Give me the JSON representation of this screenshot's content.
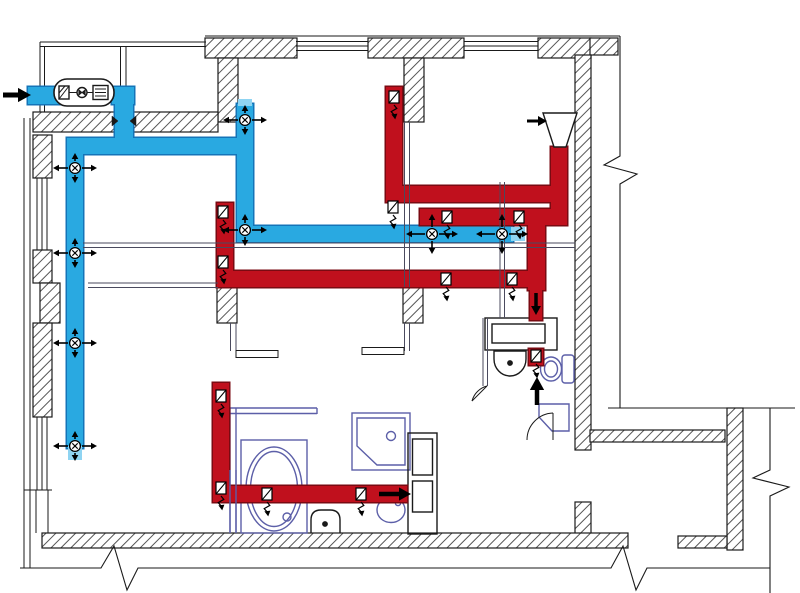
{
  "meta": {
    "title": "apartment-ventilation-duct-floor-plan",
    "canvas": {
      "width": 800,
      "height": 593,
      "background": "#ffffff"
    }
  },
  "colors": {
    "line": "#1a1a1a",
    "hatch": "#555555",
    "partition": "#4a4a5e",
    "fixture": "#5c5fa8",
    "supply_fill": "#29a9e1",
    "supply_stroke": "#1474b8",
    "supply_light": "#8fd4f2",
    "exhaust_fill": "#c0101d",
    "exhaust_stroke": "#7a0a12",
    "symbol": "#000000"
  },
  "walls": {
    "blocks": [
      [
        205,
        38,
        92,
        20
      ],
      [
        368,
        38,
        96,
        20
      ],
      [
        538,
        38,
        53,
        20
      ],
      [
        590,
        38,
        28,
        17
      ],
      [
        218,
        58,
        20,
        64
      ],
      [
        404,
        58,
        20,
        64
      ],
      [
        575,
        55,
        16,
        395
      ],
      [
        575,
        502,
        16,
        46
      ],
      [
        590,
        430,
        135,
        12
      ],
      [
        727,
        408,
        16,
        142
      ],
      [
        678,
        536,
        49,
        12
      ],
      [
        42,
        533,
        586,
        15
      ],
      [
        33,
        112,
        185,
        20
      ],
      [
        33,
        135,
        19,
        43
      ],
      [
        33,
        250,
        19,
        33
      ],
      [
        40,
        283,
        20,
        40
      ],
      [
        33,
        323,
        19,
        94
      ],
      [
        217,
        287,
        20,
        36
      ],
      [
        403,
        287,
        20,
        36
      ]
    ],
    "thin_lines": [
      [
        40,
        42,
        206,
        42
      ],
      [
        40,
        46.5,
        206,
        46.5
      ],
      [
        40,
        42,
        40,
        112
      ],
      [
        44.5,
        46.5,
        44.5,
        112
      ],
      [
        24,
        118,
        24,
        568
      ],
      [
        30,
        118,
        30,
        568
      ],
      [
        120.5,
        46.5,
        120.5,
        87
      ],
      [
        126,
        46.5,
        126,
        87
      ],
      [
        24,
        490,
        52,
        490
      ],
      [
        37,
        178,
        37,
        250
      ],
      [
        42,
        178,
        42,
        250
      ],
      [
        47,
        178,
        47,
        250
      ],
      [
        37,
        417,
        37,
        490
      ],
      [
        42,
        417,
        42,
        490
      ],
      [
        47,
        417,
        47,
        490
      ],
      [
        36,
        490,
        36,
        533
      ],
      [
        48,
        490,
        48,
        533
      ],
      [
        205,
        36,
        620,
        36
      ],
      [
        296,
        41.5,
        368,
        41.5
      ],
      [
        296,
        46,
        368,
        46
      ],
      [
        296,
        50.5,
        368,
        50.5
      ],
      [
        464,
        41.5,
        538,
        41.5
      ],
      [
        464,
        46,
        538,
        46
      ],
      [
        464,
        50.5,
        538,
        50.5
      ],
      [
        608,
        408,
        795,
        408
      ]
    ],
    "break_paths": [
      "M20,568 L101,568 L114,546 L127,590 L138,568 L611,568 L623,546 L636,590 L647,568 L770,568",
      "M770,408 L770,470 L753,478 L789,487 L770,496 L770,593",
      "M620,36 L620,156 L604,165 L637,174 L620,184 L620,408"
    ]
  },
  "partitions": {
    "lines": [
      [
        88,
        283,
        218,
        283
      ],
      [
        88,
        287.5,
        218,
        287.5
      ],
      [
        404.5,
        122,
        404.5,
        287
      ],
      [
        409.5,
        122,
        409.5,
        287
      ],
      [
        230.5,
        323,
        230.5,
        351
      ],
      [
        236,
        323,
        236,
        351
      ],
      [
        404.5,
        323,
        404.5,
        351
      ],
      [
        409.5,
        323,
        409.5,
        351
      ],
      [
        483,
        318,
        483,
        386
      ],
      [
        487.5,
        318,
        487.5,
        386
      ],
      [
        500,
        182,
        500,
        318
      ],
      [
        504.5,
        182,
        504.5,
        318
      ],
      [
        83,
        243,
        575,
        243
      ],
      [
        83,
        247.5,
        575,
        247.5
      ]
    ],
    "door_leaves": [
      [
        236,
        350.5,
        42,
        7
      ],
      [
        362,
        347.5,
        42,
        7
      ]
    ],
    "overlay_fixture_lines": [
      [
        230,
        470,
        230,
        533
      ],
      [
        236,
        470,
        236,
        533
      ]
    ]
  },
  "supply": {
    "segments": [
      [
        28,
        87,
        34,
        17
      ],
      [
        112,
        87,
        22,
        17
      ],
      [
        115,
        90,
        18,
        52
      ],
      [
        67,
        138,
        186,
        16
      ],
      [
        67,
        138,
        16,
        310
      ],
      [
        237,
        104,
        16,
        135
      ],
      [
        237,
        226,
        276,
        16
      ]
    ],
    "light_tips": [
      [
        68,
        446,
        14,
        14
      ],
      [
        238,
        99,
        14,
        7
      ],
      [
        511,
        227,
        14,
        14
      ]
    ],
    "diffusers": [
      {
        "x": 245,
        "y": 120,
        "a": 22,
        "b": 15
      },
      {
        "x": 75,
        "y": 168,
        "a": 22,
        "b": 15
      },
      {
        "x": 75,
        "y": 253,
        "a": 22,
        "b": 15
      },
      {
        "x": 75,
        "y": 343,
        "a": 22,
        "b": 15
      },
      {
        "x": 75,
        "y": 446,
        "a": 22,
        "b": 15
      },
      {
        "x": 245,
        "y": 230,
        "a": 22,
        "b": 16
      },
      {
        "x": 432,
        "y": 234,
        "a": 26,
        "b": 20
      },
      {
        "x": 502,
        "y": 234,
        "a": 26,
        "b": 20
      }
    ]
  },
  "exhaust": {
    "segments": [
      [
        386,
        87,
        16,
        110
      ],
      [
        386,
        186,
        181,
        16
      ],
      [
        551,
        147,
        16,
        70
      ],
      [
        420,
        209,
        147,
        16
      ],
      [
        528,
        218,
        17,
        72
      ],
      [
        530,
        290,
        12,
        30
      ],
      [
        217,
        203,
        16,
        84
      ],
      [
        217,
        271,
        328,
        16
      ],
      [
        213,
        383,
        16,
        117
      ],
      [
        213,
        486,
        194,
        16
      ],
      [
        529,
        349,
        14,
        16
      ]
    ],
    "grilles": [
      [
        394,
        97
      ],
      [
        393,
        207
      ],
      [
        223,
        212
      ],
      [
        223,
        262
      ],
      [
        447,
        217
      ],
      [
        519,
        217
      ],
      [
        446,
        279
      ],
      [
        512,
        279
      ],
      [
        221,
        396
      ],
      [
        221,
        488
      ],
      [
        267,
        494
      ],
      [
        361,
        494
      ],
      [
        536,
        356
      ]
    ]
  },
  "arrows": [
    {
      "x1": 3,
      "y1": 95,
      "x2": 31,
      "y2": 95,
      "w": 5,
      "h": 13,
      "n": "outside-air-intake-arrow"
    },
    {
      "x1": 527,
      "y1": 121,
      "x2": 547,
      "y2": 121,
      "w": 3,
      "h": 9,
      "n": "hood-flow-arrow"
    },
    {
      "x1": 536,
      "y1": 293,
      "x2": 536,
      "y2": 315,
      "w": 3.5,
      "h": 9,
      "n": "shaft-down-arrow"
    },
    {
      "x1": 537,
      "y1": 405,
      "x2": 537,
      "y2": 377,
      "w": 4.5,
      "h": 13,
      "n": "wc-up-arrow"
    },
    {
      "x1": 379,
      "y1": 494,
      "x2": 411,
      "y2": 494,
      "w": 4.5,
      "h": 12,
      "n": "bathroom-exhaust-arrow"
    }
  ],
  "symbols": [
    {
      "t": "rect",
      "x": 54,
      "y": 79,
      "w": 60,
      "h": 27,
      "rx": 13,
      "s": "bk",
      "f": "#fff",
      "sw": 1.6,
      "n": "ahu-casing"
    },
    {
      "t": "rect",
      "x": 59,
      "y": 86,
      "w": 10,
      "h": 13,
      "s": "bk",
      "f": "#fff",
      "n": "ahu-filter"
    },
    {
      "t": "line",
      "x1": 59,
      "y1": 99,
      "x2": 69,
      "y2": 86,
      "s": "bk",
      "sw": 1
    },
    {
      "t": "line",
      "x1": 59,
      "y1": 93,
      "x2": 65,
      "y2": 86,
      "s": "bk",
      "sw": 1
    },
    {
      "t": "line",
      "x1": 69,
      "y1": 92.5,
      "x2": 77,
      "y2": 92.5,
      "s": "bk",
      "sw": 1
    },
    {
      "t": "circle",
      "cx": 82,
      "cy": 92.5,
      "r": 5,
      "s": "bk",
      "f": "#fff",
      "n": "ahu-fan"
    },
    {
      "t": "path",
      "d": "M78.8,89.8 L78.8,95.2 L82,92.5 Z",
      "s": "bk",
      "f": "#1a1a1a",
      "sw": 0.8
    },
    {
      "t": "path",
      "d": "M85.2,89.8 L85.2,95.2 L82,92.5 Z",
      "s": "bk",
      "f": "#1a1a1a",
      "sw": 0.8
    },
    {
      "t": "line",
      "x1": 87,
      "y1": 92.5,
      "x2": 93,
      "y2": 92.5,
      "s": "bk",
      "sw": 1
    },
    {
      "t": "rect",
      "x": 93,
      "y": 85.5,
      "w": 15,
      "h": 14,
      "s": "bk",
      "f": "#fff",
      "n": "ahu-heater"
    },
    {
      "t": "line",
      "x1": 95,
      "y1": 89,
      "x2": 106,
      "y2": 89,
      "s": "bk",
      "sw": 1
    },
    {
      "t": "line",
      "x1": 95,
      "y1": 92.5,
      "x2": 106,
      "y2": 92.5,
      "s": "bk",
      "sw": 1
    },
    {
      "t": "line",
      "x1": 95,
      "y1": 96,
      "x2": 106,
      "y2": 96,
      "s": "bk",
      "sw": 1
    },
    {
      "t": "path",
      "d": "M543,113 L577,113 L566,147 L554,147 Z",
      "s": "bk",
      "f": "#fff",
      "sw": 1.4,
      "n": "kitchen-hood"
    },
    {
      "t": "path",
      "d": "M112,116 L118,121 L112,126 Z",
      "s": "bk",
      "f": "#1a1a1a",
      "sw": 0.5,
      "n": "wall-crossing-tick"
    },
    {
      "t": "path",
      "d": "M136,116 L130,121 L136,126 Z",
      "s": "bk",
      "f": "#1a1a1a",
      "sw": 0.5,
      "n": "wall-crossing-tick"
    }
  ],
  "fixtures": [
    {
      "t": "line",
      "x1": 230,
      "y1": 408,
      "x2": 230,
      "y2": 533,
      "s": "fx",
      "n": "bathroom-wall"
    },
    {
      "t": "line",
      "x1": 236,
      "y1": 408,
      "x2": 236,
      "y2": 533,
      "s": "fx"
    },
    {
      "t": "line",
      "x1": 230,
      "y1": 408,
      "x2": 317,
      "y2": 408,
      "s": "fx"
    },
    {
      "t": "line",
      "x1": 230,
      "y1": 413.5,
      "x2": 317,
      "y2": 413.5,
      "s": "fx"
    },
    {
      "t": "line",
      "x1": 317,
      "y1": 408,
      "x2": 317,
      "y2": 414,
      "s": "fx"
    },
    {
      "t": "rect",
      "x": 241,
      "y": 440,
      "w": 66,
      "h": 93,
      "s": "fx",
      "n": "bathtub-deck"
    },
    {
      "t": "ellipse",
      "cx": 274,
      "cy": 489,
      "rx": 28,
      "ry": 42,
      "s": "fx",
      "n": "bathtub"
    },
    {
      "t": "ellipse",
      "cx": 274,
      "cy": 489,
      "rx": 23.5,
      "ry": 37.5,
      "s": "fx"
    },
    {
      "t": "circle",
      "cx": 287,
      "cy": 517,
      "r": 4,
      "s": "fx",
      "n": "bathtub-drain"
    },
    {
      "t": "rect",
      "x": 352,
      "y": 413,
      "w": 58,
      "h": 57,
      "s": "fx",
      "n": "shower-cabin"
    },
    {
      "t": "path",
      "d": "M357,418 L405,418 L405,465 L377,465 L357,446 Z",
      "s": "fx"
    },
    {
      "t": "circle",
      "cx": 391,
      "cy": 436,
      "r": 4.5,
      "s": "fx",
      "n": "shower-drain"
    },
    {
      "t": "path",
      "d": "M311,533 L311,520 Q311,510 321,510 L330,510 Q340,510 340,520 L340,533",
      "s": "bk",
      "n": "bathroom-toilet"
    },
    {
      "t": "circle",
      "cx": 325,
      "cy": 524,
      "r": 2.2,
      "s": "bk",
      "f": "#1a1a1a"
    },
    {
      "t": "ellipse",
      "cx": 391,
      "cy": 510,
      "rx": 14,
      "ry": 12.5,
      "s": "fx",
      "n": "bathroom-sink"
    },
    {
      "t": "circle",
      "cx": 398,
      "cy": 503,
      "r": 2.6,
      "s": "fx"
    },
    {
      "t": "rect",
      "x": 408,
      "y": 433,
      "w": 29,
      "h": 101,
      "s": "bk",
      "n": "cabinet"
    },
    {
      "t": "rect",
      "x": 412.5,
      "y": 439,
      "w": 20,
      "h": 36,
      "s": "bk"
    },
    {
      "t": "rect",
      "x": 412.5,
      "y": 481,
      "w": 20,
      "h": 31,
      "s": "bk"
    },
    {
      "t": "rect",
      "x": 485,
      "y": 318,
      "w": 72,
      "h": 32,
      "s": "bk",
      "f": "#fff",
      "n": "wc-counter"
    },
    {
      "t": "rect",
      "x": 492,
      "y": 324,
      "w": 53,
      "h": 19,
      "s": "bk"
    },
    {
      "t": "path",
      "d": "M494,351 L526,351 L526,359 A16,17 0 0 1 494,359 Z",
      "s": "bk",
      "n": "wc-sink"
    },
    {
      "t": "circle",
      "cx": 510,
      "cy": 363,
      "r": 2.2,
      "s": "bk",
      "f": "#1a1a1a"
    },
    {
      "t": "ellipse",
      "cx": 551,
      "cy": 369,
      "rx": 10.5,
      "ry": 12,
      "s": "fx",
      "n": "wc-toilet"
    },
    {
      "t": "ellipse",
      "cx": 551,
      "cy": 369,
      "rx": 6.5,
      "ry": 8,
      "s": "fx"
    },
    {
      "t": "rect",
      "x": 562,
      "y": 355,
      "w": 12,
      "h": 28,
      "rx": 3,
      "s": "fx"
    },
    {
      "t": "path",
      "d": "M539,404 L569,404 L569,431 L552,431 L539,417 Z",
      "s": "fx",
      "n": "washing-machine"
    },
    {
      "t": "path",
      "d": "M527,440 A27,27 0 0 1 553,413",
      "s": "bk",
      "sw": 1,
      "n": "door-swing"
    },
    {
      "t": "line",
      "x1": 553,
      "y1": 413,
      "x2": 553,
      "y2": 440,
      "s": "bk",
      "sw": 1
    },
    {
      "t": "path",
      "d": "M472,401 A21,21 0 0 1 487,386",
      "s": "bk",
      "sw": 1,
      "n": "door-swing"
    },
    {
      "t": "line",
      "x1": 487,
      "y1": 386,
      "x2": 472,
      "y2": 401,
      "s": "bk",
      "sw": 1
    }
  ]
}
